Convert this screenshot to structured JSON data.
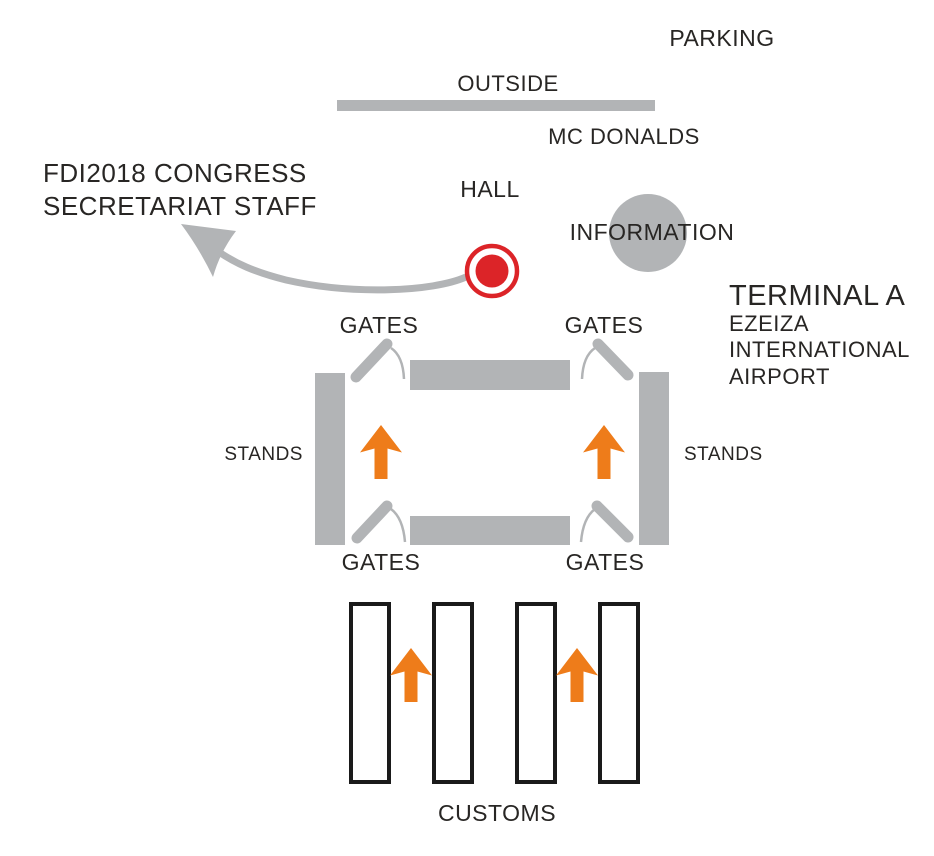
{
  "colors": {
    "background": "#ffffff",
    "gray": "#b2b4b6",
    "orange": "#ee7c1a",
    "red": "#dc2428",
    "text": "#282624",
    "outline": "#1a1a1a"
  },
  "outside_area": {
    "parking_label": "PARKING",
    "outside_label": "OUTSIDE",
    "mcdonalds_label": "MC DONALDS"
  },
  "hall_area": {
    "hall_label": "HALL",
    "information_label": "INFORMATION"
  },
  "meeting_point": {
    "line1": "FDI2018 CONGRESS",
    "line2": "SECRETARIAT STAFF"
  },
  "terminal": {
    "name": "TERMINAL A",
    "airport_line1": "EZEIZA",
    "airport_line2": "INTERNATIONAL",
    "airport_line3": "AIRPORT",
    "gates_label": "GATES",
    "stands_label": "STANDS"
  },
  "customs": {
    "label": "CUSTOMS"
  },
  "icons": {
    "meeting_point_marker": "red-target-dot-icon",
    "route_arrow": "curved-arrow-icon",
    "direction_arrow": "up-arrow-icon",
    "gate_door": "open-gate-door-icon",
    "information_circle": "gray-circle-icon"
  }
}
